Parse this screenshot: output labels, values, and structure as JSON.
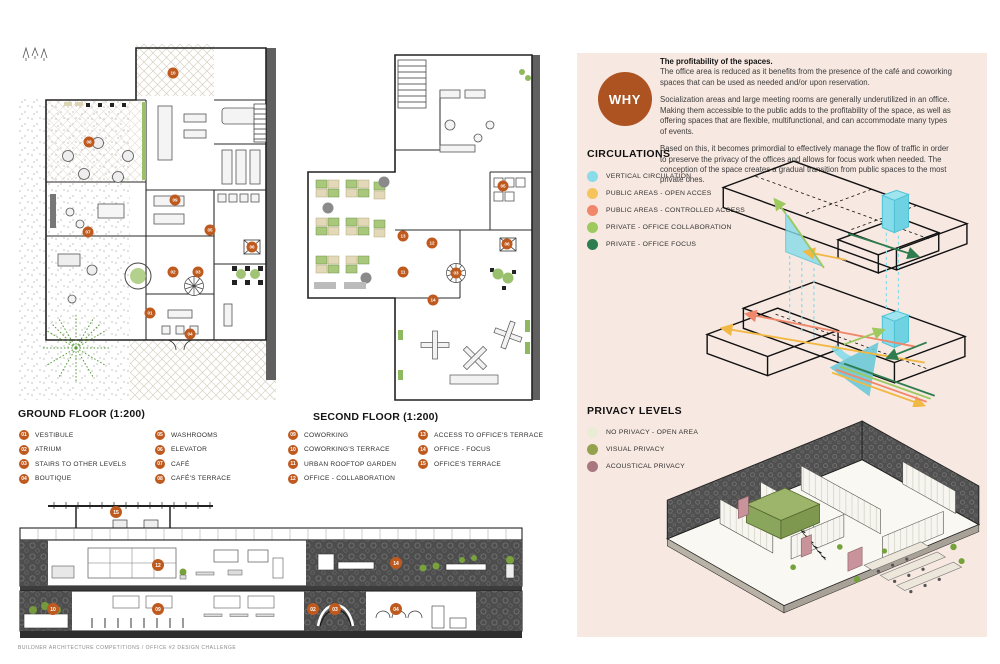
{
  "page": {
    "footer": "BUILDNER ARCHITECTURE COMPETITIONS / OFFICE #2 DESIGN CHALLENGE"
  },
  "ground_floor": {
    "title": "GROUND FLOOR (1:200)",
    "markers": [
      {
        "n": "10",
        "x": 155,
        "y": 29
      },
      {
        "n": "08",
        "x": 71,
        "y": 98
      },
      {
        "n": "09",
        "x": 157,
        "y": 156
      },
      {
        "n": "05",
        "x": 192,
        "y": 186
      },
      {
        "n": "07",
        "x": 70,
        "y": 188
      },
      {
        "n": "06",
        "x": 234,
        "y": 203
      },
      {
        "n": "02",
        "x": 155,
        "y": 228
      },
      {
        "n": "03",
        "x": 180,
        "y": 228
      },
      {
        "n": "01",
        "x": 132,
        "y": 269
      },
      {
        "n": "04",
        "x": 172,
        "y": 290
      }
    ]
  },
  "second_floor": {
    "title": "SECOND FLOOR (1:200)",
    "markers": [
      {
        "n": "05",
        "x": 203,
        "y": 156
      },
      {
        "n": "13",
        "x": 103,
        "y": 206
      },
      {
        "n": "12",
        "x": 132,
        "y": 213
      },
      {
        "n": "06",
        "x": 207,
        "y": 214
      },
      {
        "n": "11",
        "x": 103,
        "y": 242
      },
      {
        "n": "03",
        "x": 156,
        "y": 243
      },
      {
        "n": "14",
        "x": 133,
        "y": 270
      }
    ]
  },
  "section": {
    "markers": [
      {
        "n": "15",
        "x": 98,
        "y": 14
      },
      {
        "n": "12",
        "x": 140,
        "y": 67
      },
      {
        "n": "14",
        "x": 378,
        "y": 65
      },
      {
        "n": "10",
        "x": 35,
        "y": 111
      },
      {
        "n": "09",
        "x": 140,
        "y": 111
      },
      {
        "n": "02",
        "x": 295,
        "y": 111
      },
      {
        "n": "03",
        "x": 317,
        "y": 111
      },
      {
        "n": "04",
        "x": 378,
        "y": 111
      }
    ]
  },
  "legend_ground": [
    {
      "num": "01",
      "label": "VESTIBULE"
    },
    {
      "num": "02",
      "label": "ATRIUM"
    },
    {
      "num": "03",
      "label": "STAIRS TO OTHER LEVELS"
    },
    {
      "num": "04",
      "label": "BOUTIQUE"
    },
    {
      "num": "05",
      "label": "WASHROOMS"
    },
    {
      "num": "06",
      "label": "ELEVATOR"
    },
    {
      "num": "07",
      "label": "CAFÉ"
    },
    {
      "num": "08",
      "label": "CAFÉ'S TERRACE"
    }
  ],
  "legend_second": [
    {
      "num": "09",
      "label": "COWORKING"
    },
    {
      "num": "10",
      "label": "COWORKING'S TERRACE"
    },
    {
      "num": "11",
      "label": "URBAN ROOFTOP GARDEN"
    },
    {
      "num": "12",
      "label": "OFFICE - COLLABORATION"
    },
    {
      "num": "13",
      "label": "ACCESS TO OFFICE'S TERRACE"
    },
    {
      "num": "14",
      "label": "OFFICE - FOCUS"
    },
    {
      "num": "15",
      "label": "OFFICE'S TERRACE"
    }
  ],
  "why": {
    "badge": "WHY",
    "heading": "The profitability of the spaces.",
    "paragraphs": [
      "The office area is reduced as it benefits from the presence of the café and coworking spaces that can be used as needed and/or upon reservation.",
      "Socialization areas and large meeting rooms are generally underutilized in an office. Making them accessible to the public adds to the profitability of the space, as well as offering spaces that are flexible, multifunctional, and can accommodate many types of events.",
      "Based on this, it becomes primordial to effectively manage the flow of traffic in order to preserve the privacy of the offices and allows for focus work when needed. The conception of the space creates a gradual transition from public spaces to the most private ones."
    ]
  },
  "circulations": {
    "title": "CIRCULATIONS",
    "items": [
      {
        "label": "VERTICAL CIRCULATION",
        "color": "#8ADCE8"
      },
      {
        "label": "PUBLIC AREAS - OPEN ACCES",
        "color": "#F5C45B"
      },
      {
        "label": "PUBLIC AREAS - CONTROLLED ACCESS",
        "color": "#F0876B"
      },
      {
        "label": "PRIVATE - OFFICE COLLABORATION",
        "color": "#9DC95F"
      },
      {
        "label": "PRIVATE - OFFICE FOCUS",
        "color": "#2F7D4E"
      }
    ]
  },
  "privacy": {
    "title": "PRIVACY LEVELS",
    "items": [
      {
        "label": "NO PRIVACY - OPEN AREA",
        "color": "#E9EDD6"
      },
      {
        "label": "VISUAL PRIVACY",
        "color": "#94A24D"
      },
      {
        "label": "ACOUSTICAL PRIVACY",
        "color": "#A97780"
      }
    ]
  },
  "colors": {
    "panel_bg": "#F7E8E1",
    "why_circle": "#AD5322",
    "marker": "#BF5A1F"
  }
}
